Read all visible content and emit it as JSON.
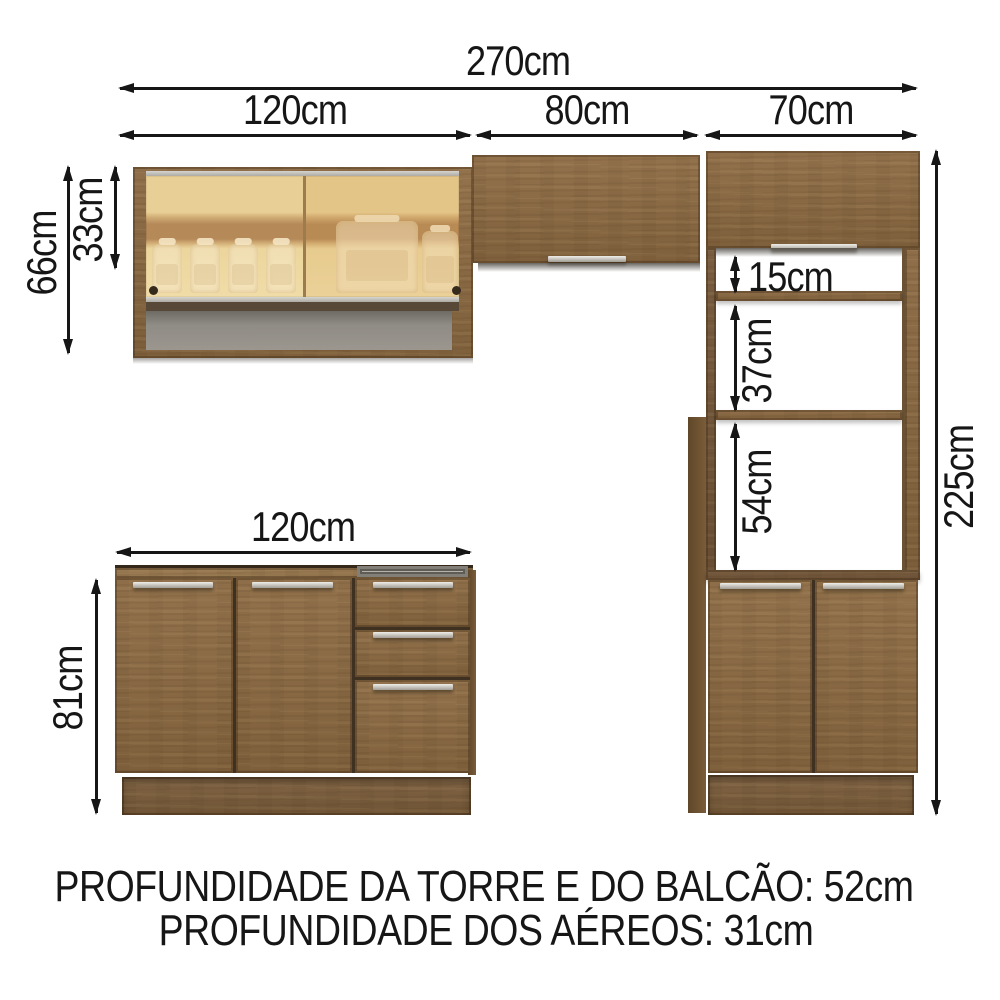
{
  "dimensions": {
    "total_width": "270cm",
    "upper_cabinet_1_width": "120cm",
    "upper_cabinet_2_width": "80cm",
    "upper_cabinet_3_width": "70cm",
    "upper_cabinet_total_height": "66cm",
    "upper_cabinet_glass_door_height": "33cm",
    "tower_niche_1_height": "15cm",
    "tower_niche_2_height": "37cm",
    "tower_oven_niche_height": "54cm",
    "tower_total_height": "225cm",
    "base_cabinet_width": "120cm",
    "base_cabinet_height": "81cm"
  },
  "footer_notes": {
    "line1": "PROFUNDIDADE DA TORRE E DO BALCÃO: 52cm",
    "line2": "PROFUNDIDADE DOS AÉREOS: 31cm"
  },
  "colors": {
    "dimension_ink": "#161616",
    "wood": "#8d6b43",
    "wood_dark": "#75583a",
    "glass_tint": "#e3bc74",
    "handle_silver": "#c9c6c0",
    "niche_interior_gray": "#9b978f",
    "background": "#ffffff"
  }
}
